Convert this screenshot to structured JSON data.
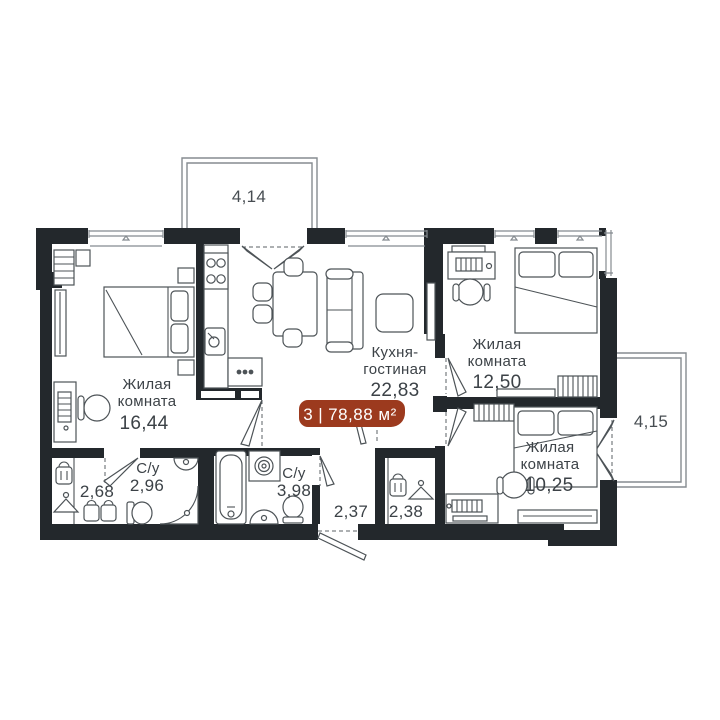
{
  "plan": {
    "title": "apartment-floor-plan",
    "badge": {
      "rooms": "3",
      "divider": "|",
      "area": "78,88 м²"
    },
    "labels": {
      "bedroom1": {
        "l1": "Жилая",
        "l2": "комната",
        "area": "16,44"
      },
      "kitchen": {
        "l1": "Кухня-",
        "l2": "гостиная",
        "area": "22,83"
      },
      "bedroom2": {
        "l1": "Жилая",
        "l2": "комната",
        "area": "12,50"
      },
      "bedroom3": {
        "l1": "Жилая",
        "l2": "комната",
        "area": "10,25"
      },
      "bath1": {
        "name": "С/у",
        "area": "2,96"
      },
      "bath2": {
        "name": "С/у",
        "area": "3,98"
      },
      "wardrobe": {
        "area": "2,68"
      },
      "hallway": {
        "area": "2,37"
      },
      "closet": {
        "area": "2,38"
      },
      "balcony_top": {
        "area": "4,14"
      },
      "balcony_right": {
        "area": "4,15"
      }
    },
    "colors": {
      "wall": "#23282c",
      "accent": "#9c3a1e",
      "furniture": "#4d5357",
      "line": "#858b90",
      "dash": "#5b6166",
      "text": "#3c4247"
    }
  }
}
